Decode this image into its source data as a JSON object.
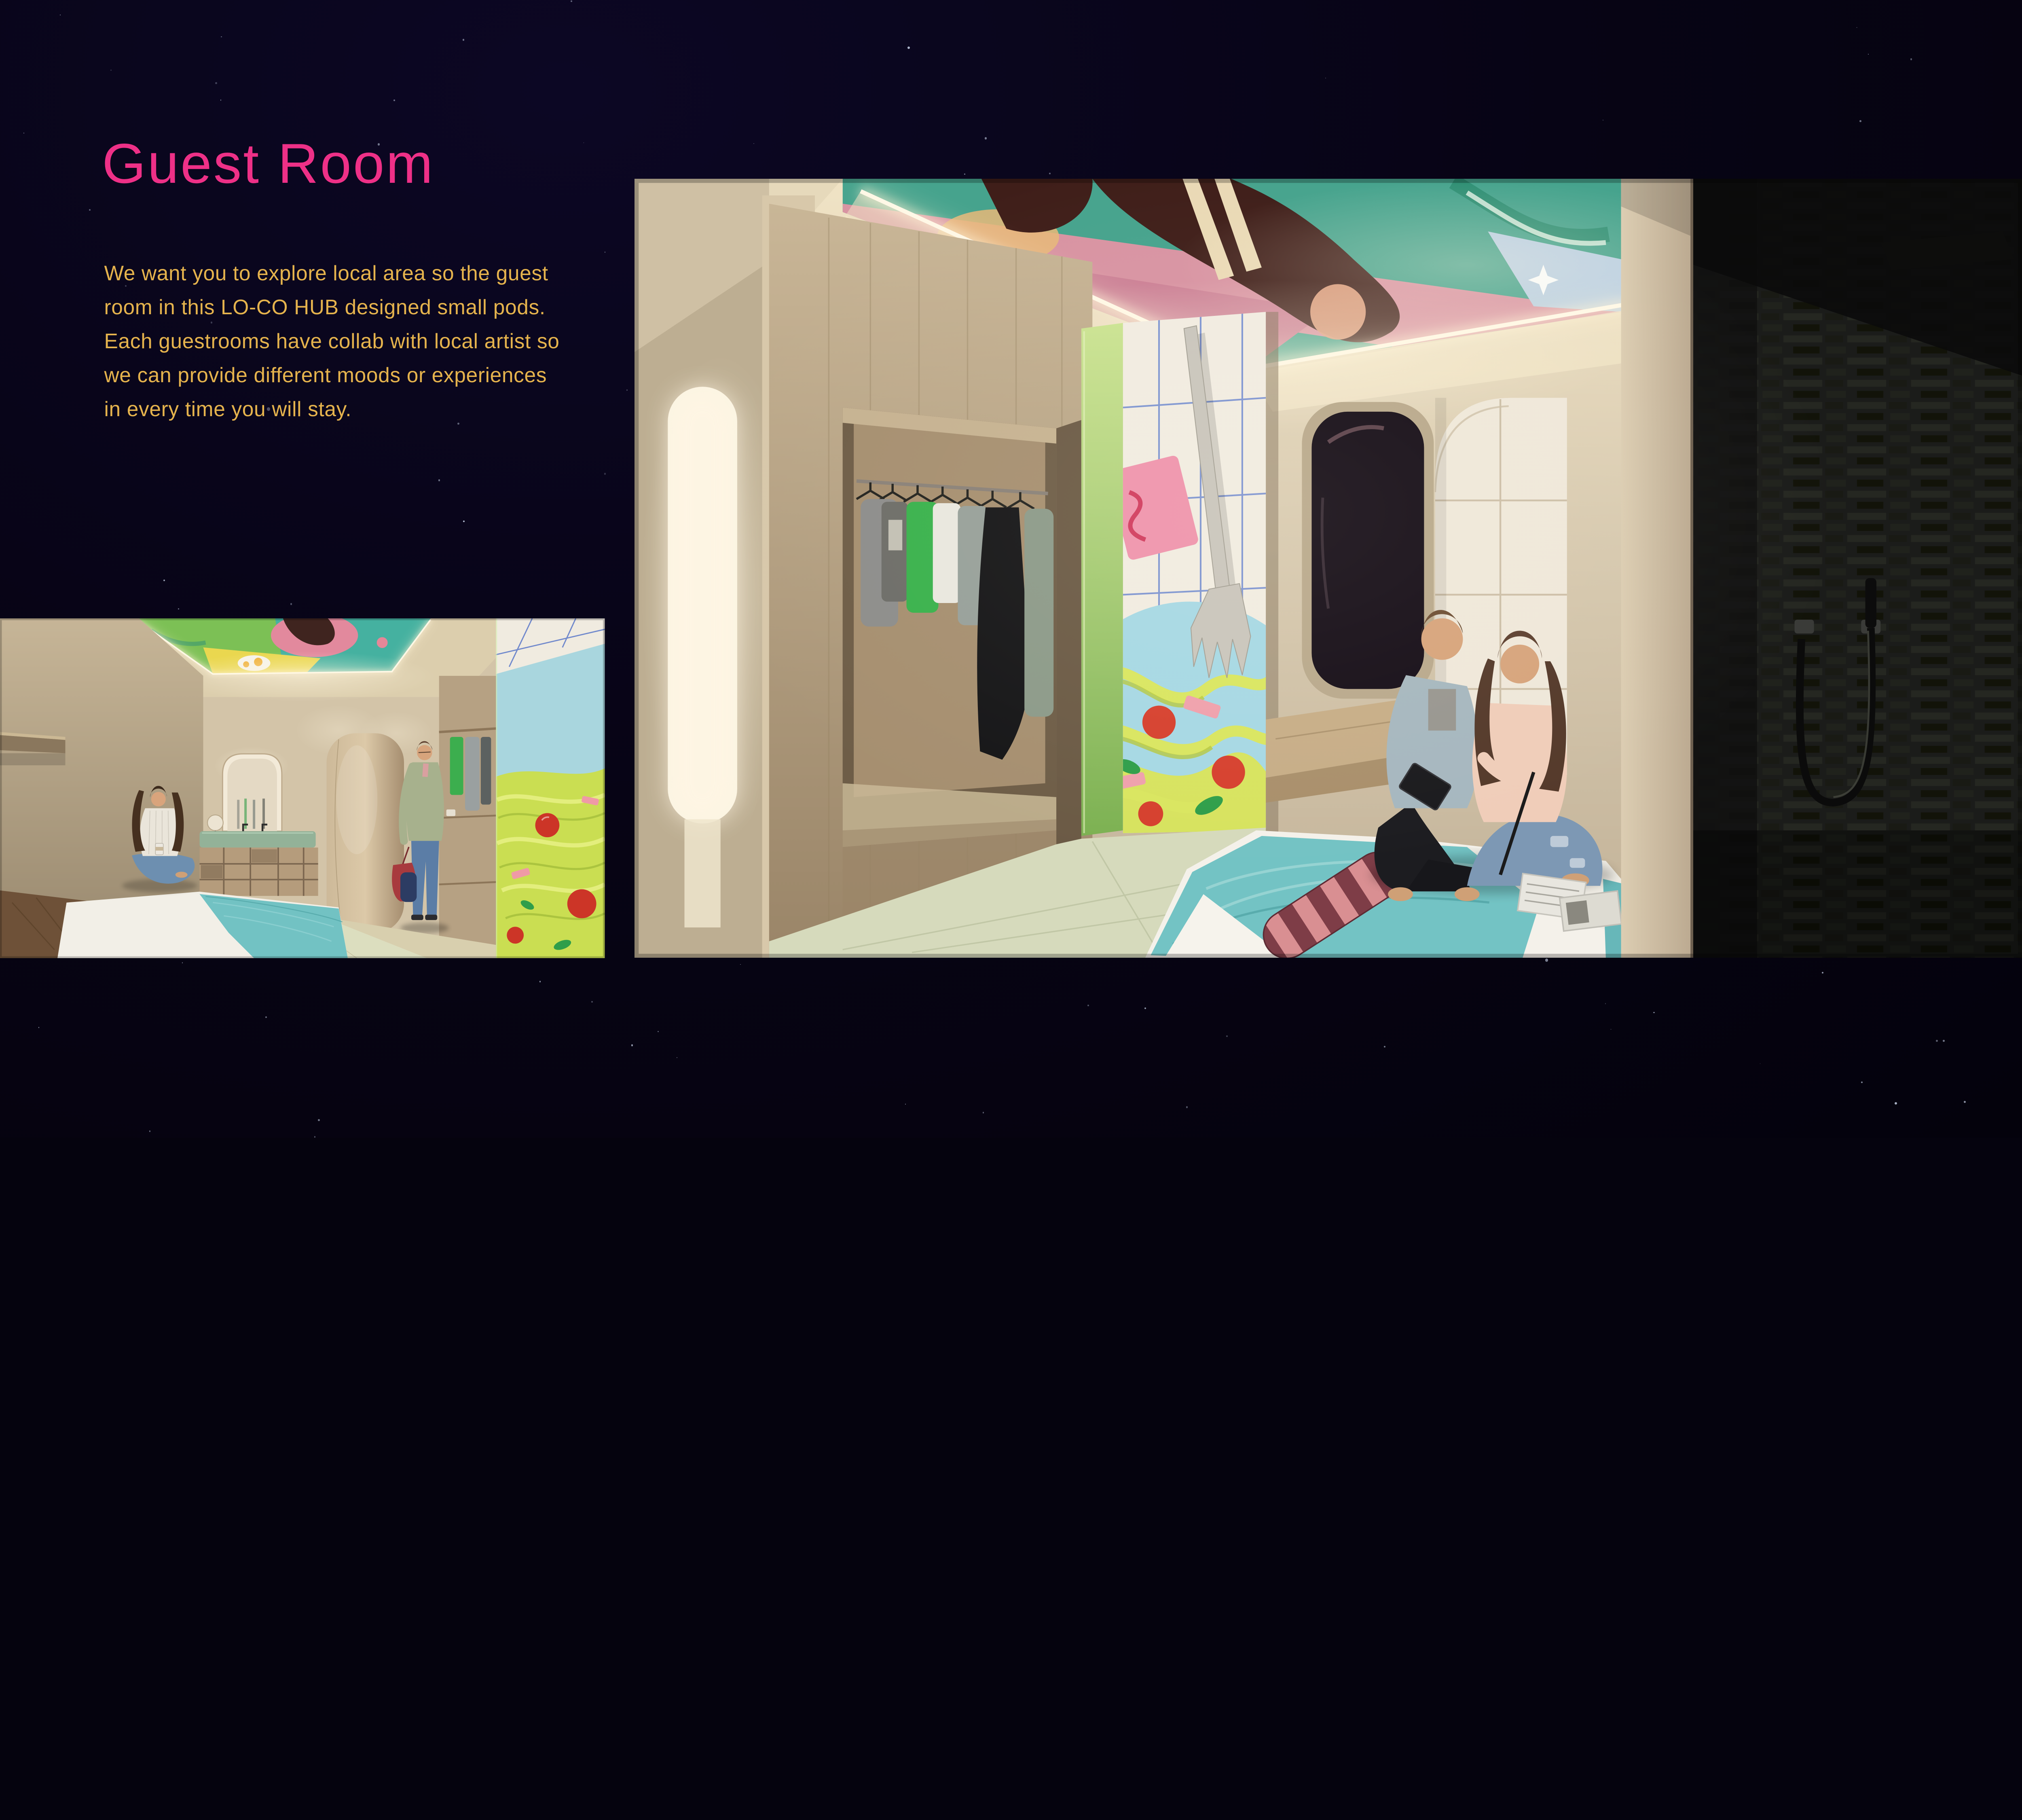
{
  "slide": {
    "title": "Guest Room",
    "body_lines": [
      "We want you to explore local area so the guest",
      "room in this LO-CO HUB designed small pods.",
      "Each guestrooms have collab with local artist so",
      "we can provide different moods or experiences",
      "in every time you will stay."
    ]
  },
  "palette": {
    "background": "#06030f",
    "title_pink": "#ee3087",
    "body_yellow": "#e5b34d",
    "led_warm": "#fff3d6",
    "wall_beige": "#d8cab0",
    "wood": "#b3997a",
    "teal_blanket": "#72c2c3",
    "mural_blue": "#a6d8e4",
    "noodle_green": "#cde05a",
    "tomato_red": "#d6402e",
    "slate_dark": "#1b1c1a"
  }
}
